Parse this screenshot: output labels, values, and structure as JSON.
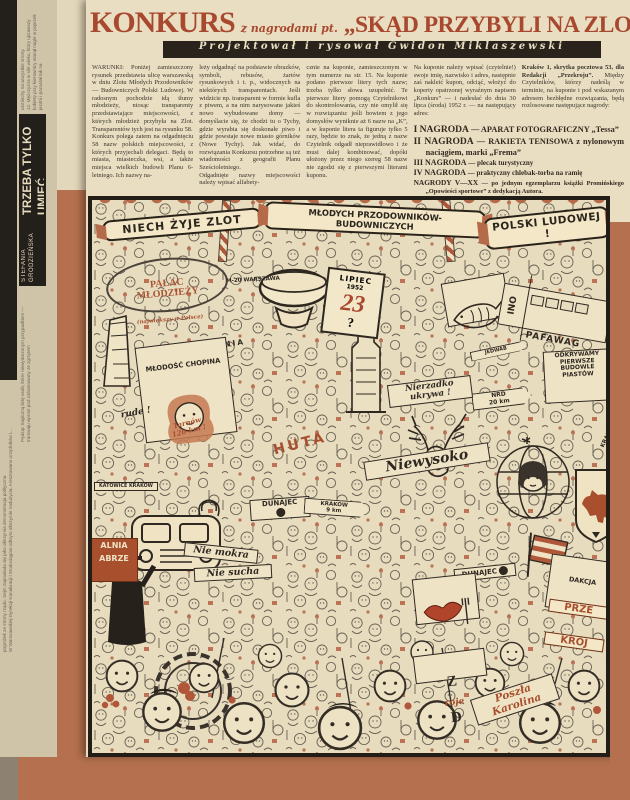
{
  "colors": {
    "background_frame": "#b5714f",
    "paper": "#e9dec2",
    "headline_red": "#a8492f",
    "accent_red": "#a8502e",
    "credit_bar": "#29231c",
    "ink": "#35302a"
  },
  "header": {
    "konkurs": "KONKURS",
    "subtitle": "z nagrodami pt.",
    "quote": "„SKĄD PRZYBYLI NA ZLOT?”",
    "credit": "Projektował i rysował Gwidon Miklaszewski"
  },
  "sidebar": {
    "frag_top": "uśmiechy na wszystkie strony.\n12. Mężczyzna w sile wieku, który ujrzawszy kobietę przy kierownicy stanął nagle w poprzek jezdni i pozostał tak na",
    "author": "STEFANIA GRODZIEŃSKA",
    "title": "TRZEBA TYLKO UMIEĆ",
    "frag_mid": "Pędząc tragiczną listę osób, które niewydarzonym przypadkiem — tramwaju wprost pod zahamowany ze zgrzytem",
    "frag_bottom": "pogróżek ze strony rządu. Sejm zapowiada się jako olbrzymia demonstracja polityczna.\nW Warszawskiej Dyrekcji Kanalizacji i Wodociągów odkryto olbrzymie nadużycia. Aresztowano urzędników i..."
  },
  "article": {
    "col1": "WARUNKI: Poniżej zamieszczony rysunek przedstawia ulicę warszawską w dniu Zlotu Młodych Przodowników — Budowniczych Polski Ludowej. W radosnym pochodzie idą tłumy młodzieży, niosąc transparenty przedstawiające miejscowości, z których młodzież przybyła na Zlot. Transparentów tych jest na rysunku 58.\nKonkurs polega zatem na odgadnięciu 58 nazw polskich miejscowości, z których przyjechali delegaci. Będą to miasta, miasteczka, wsi, a także miejsca wielkich budowli Planu 6-letniego. Ich nazwy na-",
    "col2": "leży odgadnąć na podstawie obrazków, symboli, rebusów, żartów rysunkowych i t. p., widocznych na niektórych transparentach. Jeśli widzicie np. transparent w formie kufla z piwem, a na nim narysowane jakieś nowo wybudowane domy — domyślacie się, że chodzi tu o Tychy, gdzie wyrabia się doskonałe piwo i gdzie powstaje nowe miasto górników (Nowe Tychy). Jak widać, do rozwiązania Konkursu potrzebne są też wiadomości z geografii Planu Sześcioletniego.\nOdgadnięte nazwy miejscowości należy wpisać alfabety-",
    "col3": "cznie na kuponie, zamieszczonym w tym numerze na str. 15. Na kuponie podano pierwsze litery tych nazw; trzeba tylko słowa uzupełnić. Te pierwsze litery pomogą Czytelnikowi do skontrolowania, czy nie omylił się w rozwiązaniu: jeśli bowiem z jego domysłów wyniknie aż 6 nazw na „K”, a w kuponie litera ta figuruje tylko 5 razy, będzie to znak, że jedną z nazw Czytelnik odgadł nieprawidłowo i że musi dalej kombinować, dopóki ułożony przez niego szereg 58 nazw nie zgodzi się z pierwszymi literami kuponu.",
    "col4": "Na kuponie należy wpisać (czytelnie!) swoje imię, nazwisko i adres, następnie zaś nakleić kupon, odciąć, włożyć do koperty opatrzonej wyraźnym napisem „Konkurs” — i nadesłać do dnia 30 lipca (środa) 1952 r. — na następujący adres:",
    "col5_address": "Kraków 1, skrytka pocztowa 53, dla Redakcji „Przekroju”.",
    "col5_rest": "Między Czytelników, którzy nadeślą w terminie, na kuponie i pod wskazanym adresem bezbłędne rozwiązania, będą rozlosowane następujące nagrody:",
    "prizes": {
      "p1": {
        "label": "I NAGRODA",
        "desc": "— APARAT FOTOGRAFICZNY „Tessa”"
      },
      "p2": {
        "label": "II NAGRODA",
        "desc": "— RAKIETA TENISOWA z nylonowym naciągiem, marki „Frema”"
      },
      "p3": {
        "label": "III NAGRODA",
        "desc": "— plecak turystyczny"
      },
      "p4": {
        "label": "IV NAGRODA",
        "desc": "— praktyczny chlebak-torba na ramię"
      },
      "p5": {
        "label": "NAGRODY V—XX",
        "desc": "— po jednym egzemplarzu książki Promińskiego „Opowieści sportowe” z dedykacją Autora."
      }
    }
  },
  "illustration": {
    "ribbon1": "NIECH ŻYJE ZLOT",
    "ribbon2": "MŁODYCH PRZODOWNIKÓW-BUDOWNICZYCH",
    "ribbon3": "POLSKI LUDOWEJ !",
    "signs": {
      "palac_line1": "PAŁAC\nMŁODZIEŻY",
      "palac_line2": "(największy w Polsce)",
      "m20": "M-20 WARSZAWA",
      "teznia": "TĘŻNIA",
      "chopin": "MŁODOŚĆ CHOPINA",
      "calendar_month": "LIPIEC",
      "calendar_year": "1952",
      "calendar_day": "23",
      "calendar_mark": "?",
      "lub": "LUB",
      "ino": "INO",
      "pafawag": "PAFAWAG",
      "jedwab": "JEDWAB",
      "odkrywamy": "ODKRYWAMY\nPIERWSZE\nBUDOWLE\nPIASTÓW",
      "nrd": "NRD\n20 km",
      "nierzadko": "Nierzadko\nukrywa !",
      "niewysoko": "Niewysoko",
      "rude": "rude !",
      "tarnow": "Tarnów\n120 km !",
      "katowice": "KATOWICE  KRAKÓW",
      "huta": "HUTA",
      "dunajec1": "DUNAJEC",
      "krakow9": "KRAKÓW\n9 km",
      "zabrze": "ALNIA\nABRZE",
      "niemokra": "Nie mokra",
      "niesucha": "Nie sucha",
      "dunajec2": "DUNAJEC",
      "redakcja_line1": "DAKCJA",
      "redakcja_line2": "PRZE",
      "redakcja_line3": "KRÓJ",
      "zrojed_a": "Z",
      "zrojed_b": "roje",
      "zrojed_c": "D",
      "karolina": "Poszła\nKarolina",
      "krasna": "KRASNA WODA"
    }
  }
}
